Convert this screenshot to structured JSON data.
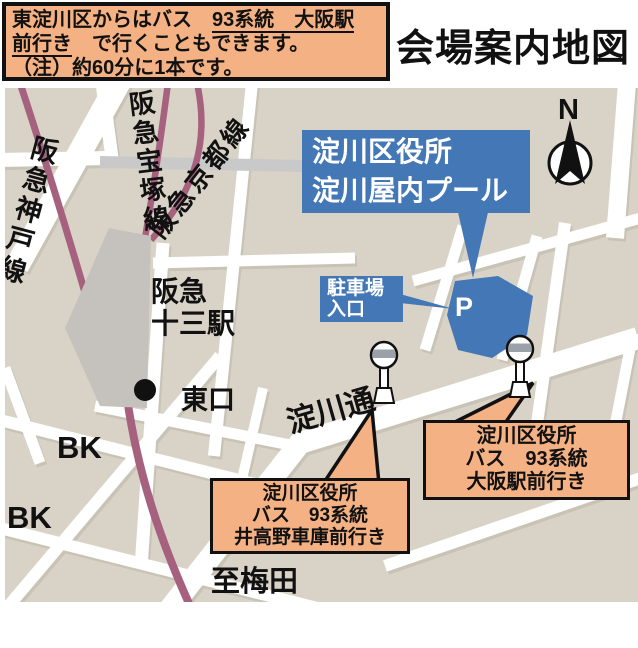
{
  "title": "会場案内地図",
  "info_box": {
    "line1_pre": "東淀川区からはバス　",
    "line1_underlined": "93系統　大阪駅",
    "line2_underlined": "前行き",
    "line2_post": "　で行くこともできます。",
    "line3": "（注）約60分に1本です。"
  },
  "map": {
    "north_label": "N",
    "venue_label": {
      "line1": "淀川区役所",
      "line2": "淀川屋内プール"
    },
    "parking_label": {
      "line1": "駐車場",
      "line2": "入口"
    },
    "parking_mark": "P",
    "rails": {
      "kobe": "阪急神戸線",
      "takarazuka": "阪急宝塚線",
      "kyoto": "阪急京都線"
    },
    "station": {
      "line1": "阪急",
      "line2": "十三駅"
    },
    "east_exit": "東口",
    "bank1": "BK",
    "bank2": "BK",
    "street_name": "淀川通",
    "to_umeda": "至梅田",
    "callout_osaka": {
      "line1": "淀川区役所",
      "line2": "バス　93系統",
      "line3": "大阪駅前行き"
    },
    "callout_itakano": {
      "line1": "淀川区役所",
      "line2": "バス　93系統",
      "line3": "井高野車庫前行き"
    }
  },
  "colors": {
    "accent_blue": "#4377B5",
    "callout_orange": "#F4B183",
    "rail_purple": "#A5617E",
    "map_bg": "#D9D3C7",
    "street_gray": "#C9C9C9"
  }
}
